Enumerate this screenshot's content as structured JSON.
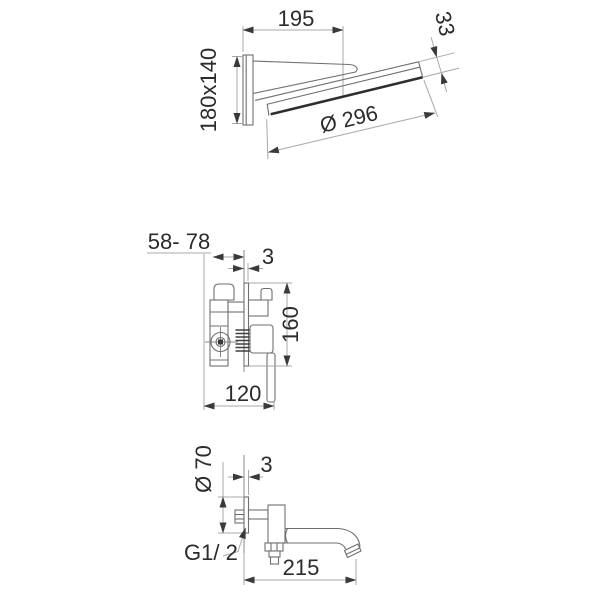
{
  "drawing": {
    "type": "technical-dimension-drawing",
    "background": "#ffffff",
    "line_color": "#6f6f6f",
    "dim_line_color": "#a8a8a8",
    "text_color": "#2b2b2b",
    "thick_edge_color": "#2e2e2e",
    "views": [
      {
        "id": "showerhead",
        "name": "wall-mounted waterfall shower head - side view",
        "dims": {
          "projection": "195",
          "head_thickness": "33",
          "wall_plate": "180x140",
          "head_diameter": "Ø 296"
        }
      },
      {
        "id": "mixer",
        "name": "concealed single-lever mixer valve - side view",
        "dims": {
          "install_depth": "58- 78",
          "plate_offset": "3",
          "trim_height": "160",
          "trim_width": "120"
        }
      },
      {
        "id": "spout",
        "name": "wall-mounted spout - side view",
        "dims": {
          "flange_diameter": "Ø 70",
          "plate_offset": "3",
          "thread": "G1/ 2",
          "projection": "215"
        }
      }
    ]
  }
}
